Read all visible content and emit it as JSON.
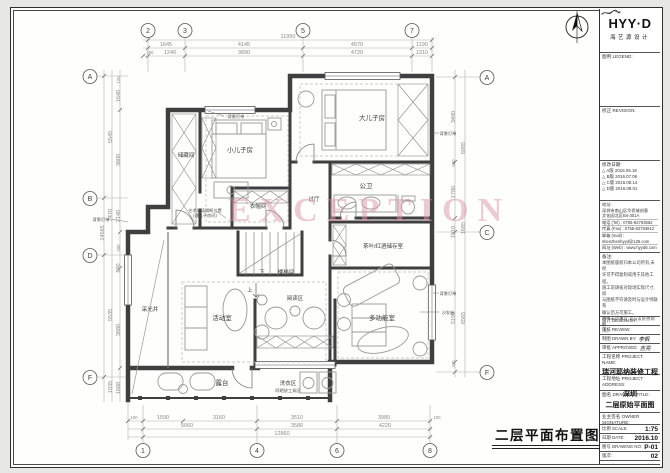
{
  "sheet": {
    "wall_color": "#3f3f3f",
    "furn_color": "#999999",
    "dim_color": "#8a8a8a",
    "watermark_color": "#d898ab"
  },
  "watermark": "EXCEPTION",
  "plan_title": "二层平面布置图",
  "grid": {
    "top": [
      "2",
      "3",
      "5",
      "7"
    ],
    "bottom": [
      "1",
      "4",
      "6",
      "8"
    ],
    "left": [
      "A",
      "B",
      "D",
      "F"
    ],
    "right": [
      "A",
      "C",
      "F"
    ]
  },
  "dims": {
    "top_total": "11950",
    "top_row1": [
      "1645",
      "4145",
      "4970",
      "1190"
    ],
    "top_row2": [
      "180",
      "1240",
      "3890",
      "4720",
      "1310"
    ],
    "bottom_row1": [
      "100",
      "1590",
      "3160",
      "3510",
      "3980",
      "100"
    ],
    "bottom_row2": [
      "5060",
      "3580",
      "4220"
    ],
    "bottom_total": "12860",
    "left_total": "14585",
    "left_mid": [
      "5545",
      "2470",
      "5535",
      "1035"
    ],
    "left_inner": [
      "120",
      "1640",
      "3800",
      "2140",
      "200",
      "890",
      "3880",
      "1688"
    ],
    "right_outer": [
      "6985",
      "1685",
      "6565"
    ],
    "right_inner": [
      "3490",
      "600",
      "1780",
      "1910",
      "5190",
      "320"
    ]
  },
  "rooms": {
    "storage": "储藏间",
    "young_son": "小儿子房",
    "elder_son": "大儿子房",
    "bath": "公卫",
    "hall": "过厅",
    "cloak": "衣帽间",
    "stair": "楼梯间",
    "tea_wine": "茶叶/红酒储存室",
    "reading": "阅读区",
    "activity": "活动室",
    "light_well": "采光井",
    "multi": "多功能室",
    "terrace": "露台",
    "laundry": "洗衣区",
    "laundry_note": "晾晒放工具区"
  },
  "notes": {
    "bg_light": "背景灯带",
    "art_glass": "艺术玻璃隔断位置",
    "art_glass2": "(通儿子房间)",
    "sofa_bed": "沙发床",
    "down": "下",
    "up": "上"
  },
  "title_block": {
    "logo": "HYY·D",
    "logo_sub": "海艺源设计",
    "legend": "图例 LEGEND:",
    "revision": "修正 REVISION:",
    "dates_label": "修改日期:",
    "dates": [
      "△ A版 2016.06.18",
      "△ B版 2016.07.06",
      "△ C版 2016.08.14",
      "△ D版 2016.09.01"
    ],
    "address_label": "地址:",
    "address1": "深圳市南山区华侨城创意",
    "address2": "文化园北区B4-301A",
    "tel": "电话 (Tel) : 0755-82793562",
    "fax": "传真 (Fax) : 0755-82793912",
    "mail": "邮箱 (mail) : shenzhenhyyd@126.com",
    "web": "网址 (Web) : www.hyyd8.com",
    "notes_label": "备注:",
    "note_lines": [
      "本图纸版权归本公司所有,未经",
      "许可不得复制或用于其他工程。",
      "施工前请核对现场实际尺寸,如",
      "与图纸不符请及时与设计师联系",
      "确认后方可施工。",
      "图中未尽事宜,双方友好协商解",
      "决。"
    ],
    "design_label": "设计 DESIGN BY:",
    "review_label": "审核 REVIEW:",
    "drawn_label": "制图 DRAWN BY:",
    "drawn_value": "李枫",
    "approved_label": "审批 APPROVED:",
    "approved_value": "吉亮",
    "project_label": "工程名称 PROJECT NAME:",
    "project_value": "瑞河耶纳装修工程",
    "addr_label": "工程地址 PROJECT ADDRESS:",
    "addr_value": "深圳",
    "title_label": "图名 DRAWING TITLE:",
    "title_value": "二层原始平面图",
    "owner_label": "业主签名 OWNER SIGNATURE:",
    "scale_label": "比例 SCALE:",
    "scale_value": "1:75",
    "date_label": "日期 DATE:",
    "date_value": "2016.10",
    "no_label": "图号 DRAWING NO:",
    "no_value": "P-01",
    "rev_label": "版次:",
    "rev_value": "02"
  }
}
